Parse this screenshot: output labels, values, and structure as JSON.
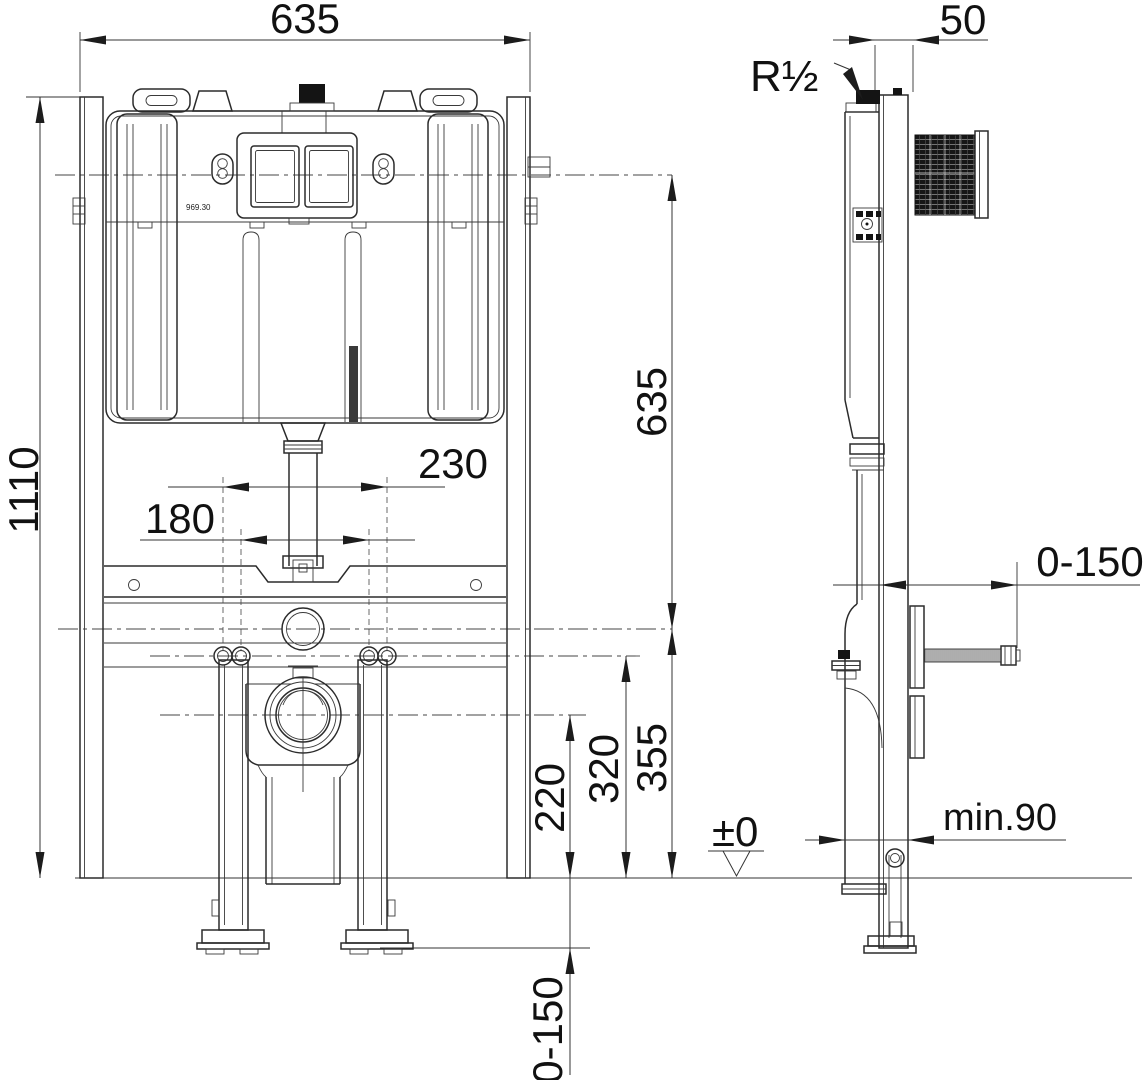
{
  "front_view": {
    "name": "front view",
    "dimensions": {
      "overall_width": "635",
      "overall_height": "1110",
      "fixing_studs_outer_spacing": "230",
      "fixing_studs_inner_spacing": "180",
      "actuator_to_inlet_height": "635",
      "water_inlet_height": "355",
      "fixing_studs_height": "320",
      "outlet_height": "220",
      "foot_adjustment_range": "0-150"
    },
    "product_code": "969.30"
  },
  "side_view": {
    "name": "side view",
    "dimensions": {
      "top_depth": "50",
      "water_connection_thread": "R½",
      "wall_bracket_range": "0-150",
      "floor_level_mark": "±0",
      "min_wall_distance": "min.90"
    }
  }
}
